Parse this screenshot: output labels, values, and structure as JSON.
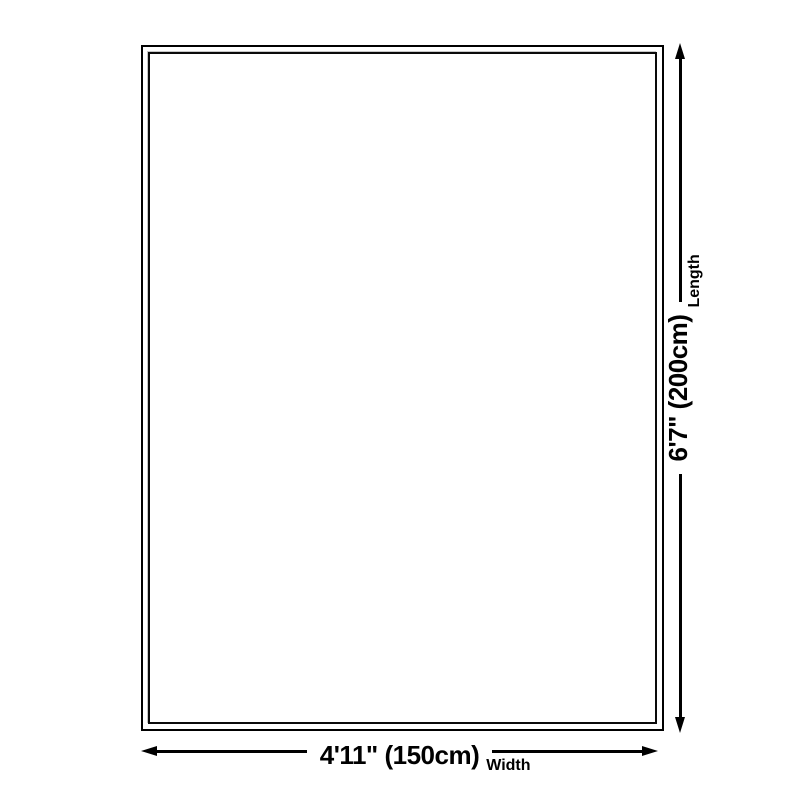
{
  "diagram": {
    "dimensions": {
      "width": {
        "value": "4'11\" (150cm)",
        "axis": "Width"
      },
      "length": {
        "value": "6'7\" (200cm)",
        "axis": "Length"
      }
    },
    "icons": {
      "horizontal_arrow_ends": [
        "arrow-left",
        "arrow-right"
      ],
      "vertical_arrow_ends": [
        "arrow-down",
        "arrow-up"
      ]
    },
    "colors": {
      "line": "#000000",
      "background": "#ffffff",
      "inner_border_highlight": "#c7c7c7"
    }
  }
}
